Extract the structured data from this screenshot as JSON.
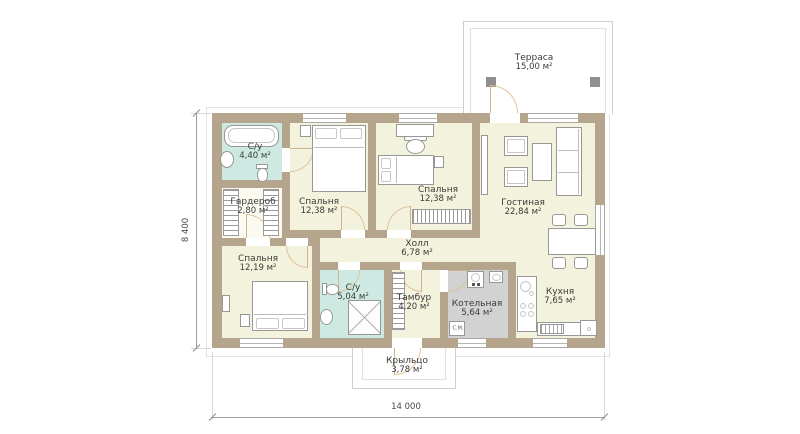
{
  "plan": {
    "rooms": {
      "terrace": {
        "name": "Терраса",
        "area": "15,00 м²"
      },
      "bath1": {
        "name": "С/у",
        "area": "4,40 м²"
      },
      "wardrobe": {
        "name": "Гардероб",
        "area": "2,80 м²"
      },
      "bedroom1": {
        "name": "Спальня",
        "area": "12,38 м²"
      },
      "bedroom2": {
        "name": "Спальня",
        "area": "12,38 м²"
      },
      "living": {
        "name": "Гостиная",
        "area": "22,84 м²"
      },
      "hall": {
        "name": "Холл",
        "area": "6,78 м²"
      },
      "bedroom3": {
        "name": "Спальня",
        "area": "12,19 м²"
      },
      "bath2": {
        "name": "С/у",
        "area": "5,04 м²"
      },
      "tambour": {
        "name": "Тамбур",
        "area": "4,20 м²"
      },
      "boiler": {
        "name": "Котельная",
        "area": "5,64 м²"
      },
      "kitchen": {
        "name": "Кухня",
        "area": "7,65 м²"
      },
      "porch": {
        "name": "Крыльцо",
        "area": "3,78 м²"
      }
    },
    "dimensions": {
      "width": "14 000",
      "height": "8 400"
    },
    "labels": {
      "washing_machine": "С.М."
    },
    "colors": {
      "wall": "#b6a58d",
      "floor": "#f3f2dc",
      "wet_floor": "#cde9e2",
      "service_floor": "#d2d2d2",
      "door_arc": "#dfc29a"
    }
  }
}
